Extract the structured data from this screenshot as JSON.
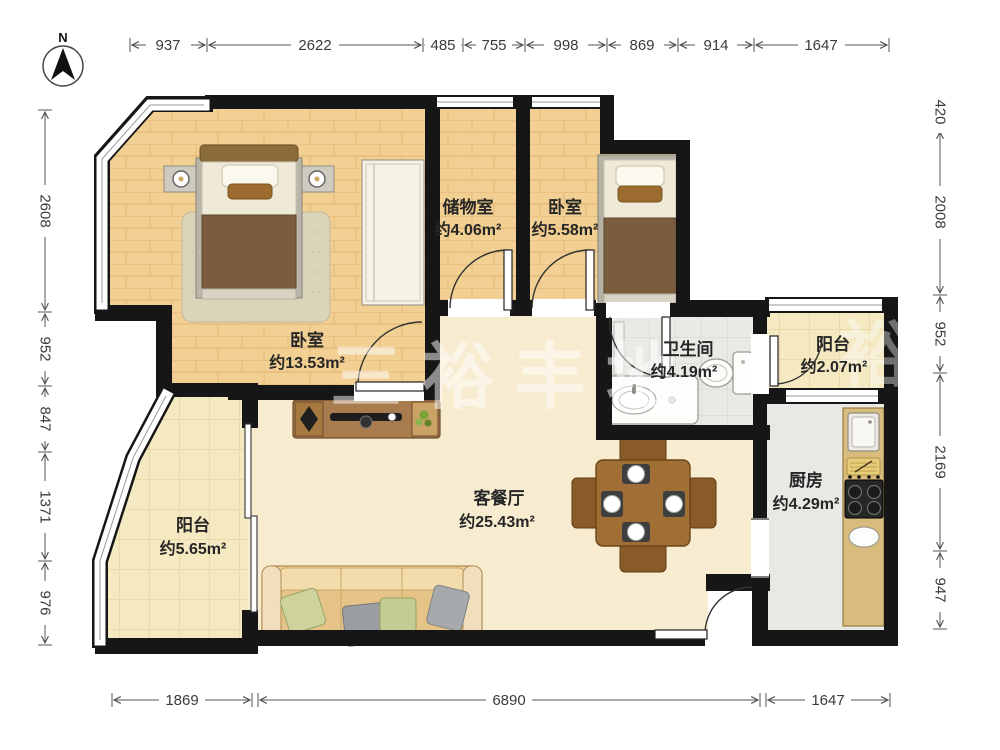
{
  "compass": {
    "label": "N"
  },
  "rooms": [
    {
      "id": "master-bedroom",
      "name": "卧室",
      "area": "约13.53m²"
    },
    {
      "id": "storage",
      "name": "储物室",
      "area": "约4.06m²"
    },
    {
      "id": "bedroom-2",
      "name": "卧室",
      "area": "约5.58m²"
    },
    {
      "id": "bathroom",
      "name": "卫生间",
      "area": "约4.19m²"
    },
    {
      "id": "balcony-right",
      "name": "阳台",
      "area": "约2.07m²"
    },
    {
      "id": "kitchen",
      "name": "厨房",
      "area": "约4.29m²"
    },
    {
      "id": "living-dining",
      "name": "客餐厅",
      "area": "约25.43m²"
    },
    {
      "id": "balcony-left",
      "name": "阳台",
      "area": "约5.65m²"
    }
  ],
  "dimensions": {
    "top": [
      "937",
      "2622",
      "485",
      "755",
      "998",
      "869",
      "914",
      "1647"
    ],
    "left": [
      "2608",
      "952",
      "847",
      "1371",
      "976"
    ],
    "right": [
      "420",
      "2008",
      "952",
      "2169",
      "947"
    ],
    "bottom": [
      "1869",
      "6890",
      "1647"
    ]
  },
  "watermark": {
    "text": "三裕丰地",
    "partial": "裕"
  },
  "colors": {
    "wall": "#161616",
    "wood_floor": "#f2cf92",
    "living_floor": "#f8ecd0",
    "balcony_tile": "#f5e9c2",
    "bath_tile": "#e9e9e5",
    "kitchen_floor": "#e8e8e4",
    "counter": "#d8bc7e",
    "furniture_brown": "#a97c50"
  }
}
